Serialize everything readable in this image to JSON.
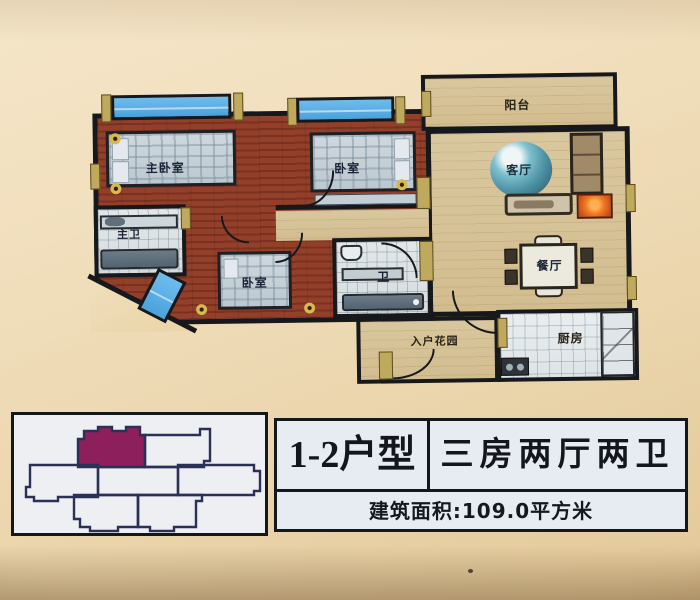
{
  "photo": {
    "background": "#eedcba",
    "vignette": "rgba(110,75,40,0.4)"
  },
  "floor_plan": {
    "labels": {
      "balcony": "阳台",
      "living_room": "客厅",
      "dining_room": "餐厅",
      "kitchen": "厨房",
      "entry_garden": "入户花园",
      "master_bedroom": "主卧室",
      "bedroom_2": "卧室",
      "bedroom_3": "卧室",
      "master_bath": "主卫",
      "bath": "卫"
    },
    "colors": {
      "wall": "#17181c",
      "wall_accent": "#bfa95c",
      "wood_floor": "#8e3d28",
      "tan_floor": "#d6c094",
      "tile_floor": "#dde2e4",
      "window": "#58b0e8",
      "tv": "#e05a14",
      "sofa": "#a08a68",
      "decor_teal": "#4e93a6"
    }
  },
  "key_plan": {
    "outline": "#2a3156",
    "highlight": "#8c1f5c",
    "background": "#edeff3"
  },
  "info_table": {
    "unit_type": "1-2户型",
    "layout": "三房两厅两卫",
    "area": "建筑面积:109.0平方米"
  }
}
